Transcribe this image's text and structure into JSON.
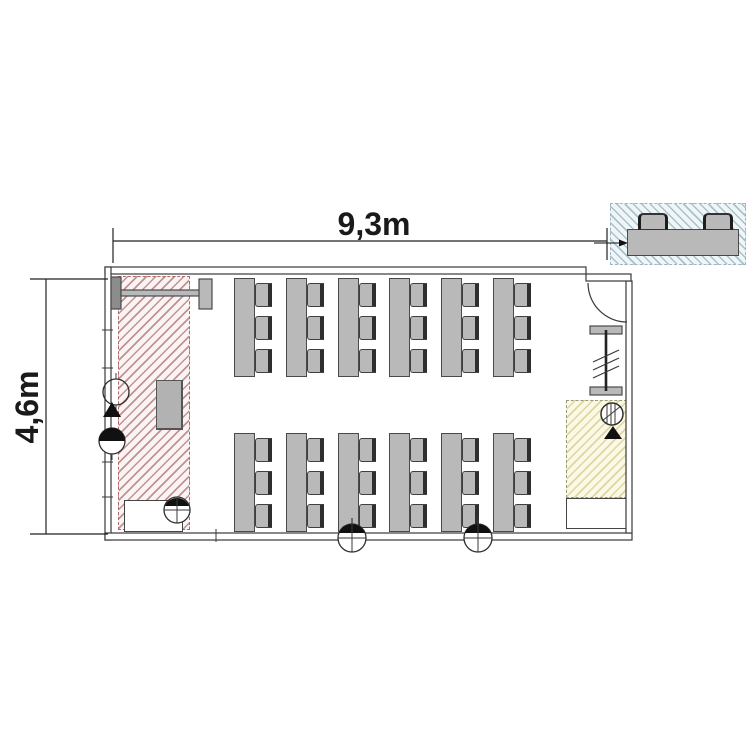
{
  "plan": {
    "type": "classroom-floor-plan",
    "dimension_labels": {
      "width": "9,3m",
      "height": "4,6m"
    }
  },
  "furniture": {
    "table_rows": 2,
    "tables_per_row": 6,
    "chairs_per_table": 3,
    "total_seats": 36,
    "detail_inset_chairs": 2
  },
  "symbols": {
    "floor_socket_icon": "circle-with-cross-and-filled-top",
    "wall_lamp_icon": "circle-outline",
    "wall_socket_icon": "circle-with-filled-top-half",
    "direction_triangle_icon": "filled-triangle-up",
    "hatched_circle_icon": "circle-with-vertical-hatch",
    "coat_rack_icon": "i-beam-with-slashes",
    "projection_screen_icon": "bar-with-end-mounts",
    "door_icon": "leaf-with-quarter-arc"
  },
  "colors": {
    "wall_line": "#3a3a3a",
    "furniture_fill": "#b9b9b9",
    "furniture_border": "#4a4a4a",
    "screen_mount_fill": "#8c8c8c",
    "symbol_fill": "#111111",
    "dimension_text": "#1a1a1a",
    "red_zone_bg": "#faf4f4",
    "red_zone_hatch": "#c49090",
    "red_zone_border": "#b06868",
    "yellow_zone_bg": "#fbf9e6",
    "yellow_zone_hatch": "#dcd6a2",
    "yellow_zone_border": "#9a9a7a",
    "blue_zone_bg": "#f0f6f8",
    "blue_zone_hatch": "#a8c2cc",
    "blue_zone_border": "#9fb6c0"
  }
}
